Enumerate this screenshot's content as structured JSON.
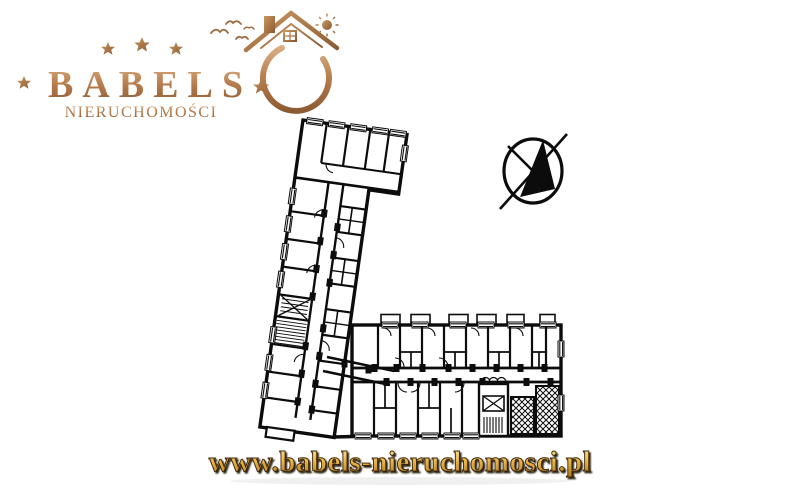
{
  "page": {
    "background_color": "#ffffff"
  },
  "logo": {
    "brand": "BABELS",
    "subtitle": "NIERUCHOMOŚCI",
    "top_star_count": 3,
    "side_star_count": 2,
    "colors": {
      "copper_light": "#e2b98e",
      "copper": "#b57b4b",
      "copper_dark": "#8c5a33"
    }
  },
  "floor_plan": {
    "description": "Black-and-white architectural floor plan of an L-shaped apartment building: tilted left wing, horizontal right wing, central corridors, stairwells, elevator shaft, balconies, cross-hatched shafts at bottom right",
    "ink_color": "#0c0c0c"
  },
  "compass": {
    "icon": "north-arrow-icon",
    "style": "circle crossed by diagonal needle with solid black triangle"
  },
  "footer": {
    "url": "www.babels-nieruchomosci.pl",
    "colors": {
      "gold_light": "#fce788",
      "gold": "#e7ae3c",
      "gold_dark": "#a87413",
      "shadow": "#1d1206"
    }
  }
}
